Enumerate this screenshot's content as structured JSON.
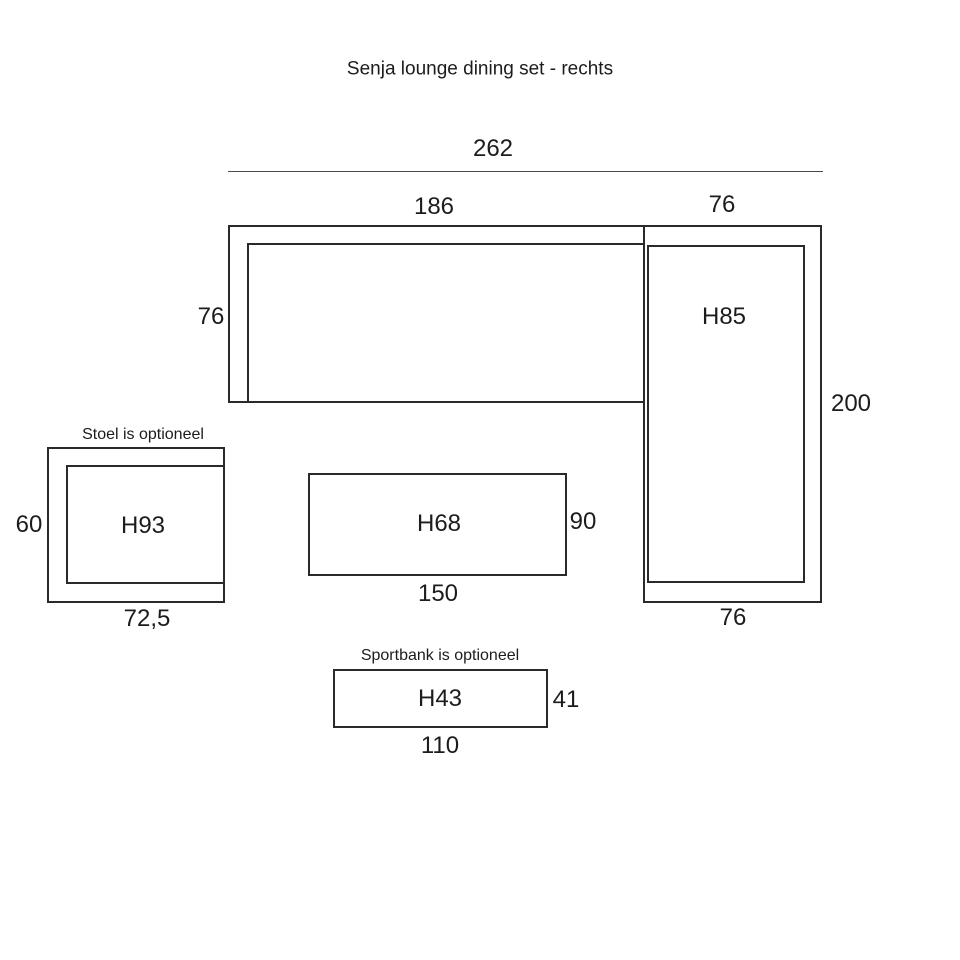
{
  "title": "Senja lounge dining set - rechts",
  "colors": {
    "background": "#ffffff",
    "ink": "#1c1c1c",
    "line": "#2a2a2a"
  },
  "sofa": {
    "total_width": "262",
    "seat_section_width": "186",
    "chaise_section_width": "76",
    "seat_depth": "76",
    "chaise_height_label": "H85",
    "total_depth": "200",
    "chaise_width": "76"
  },
  "chair": {
    "caption": "Stoel is optioneel",
    "height_label": "H93",
    "depth": "60",
    "width": "72,5"
  },
  "table": {
    "height_label": "H68",
    "depth": "90",
    "width": "150"
  },
  "bench": {
    "caption": "Sportbank is optioneel",
    "height_label": "H43",
    "depth": "41",
    "width": "110"
  }
}
